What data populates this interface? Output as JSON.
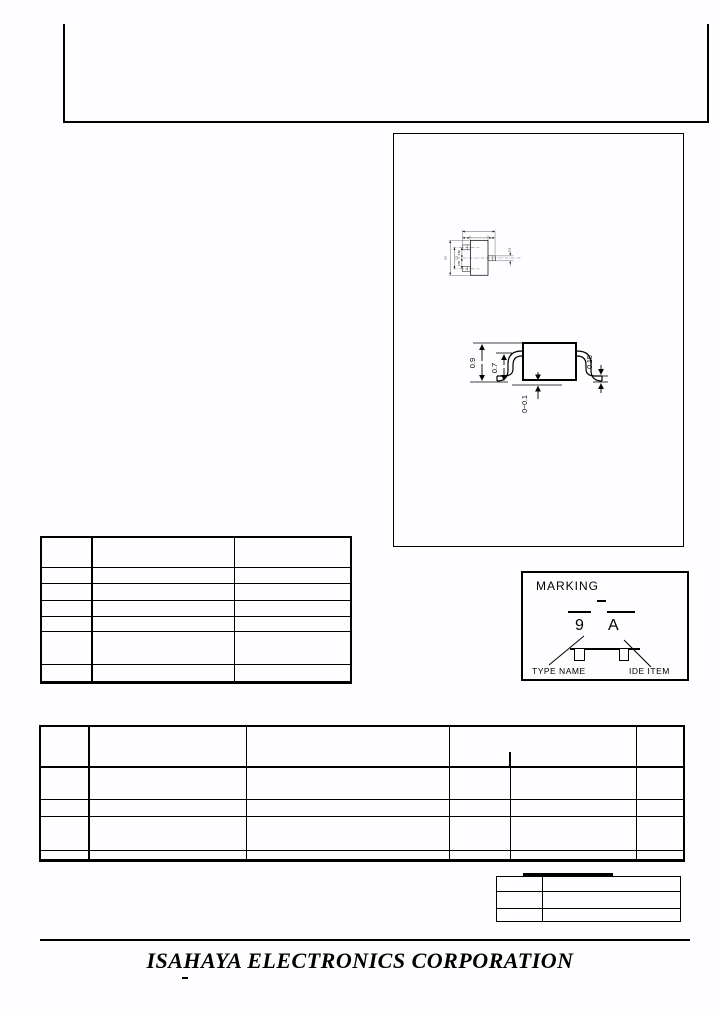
{
  "page": {
    "background": "#ffffff",
    "ink": "#000000"
  },
  "drawing": {
    "top_view": {
      "overall": "2.0",
      "lead_span": "1.3",
      "pitch_upper": "0.65",
      "pitch_lower": "0.35",
      "lead_width": "0.3"
    },
    "side_view": {
      "height": "0.9",
      "body_height": "0.7",
      "standoff": "0~0.1",
      "lead_thickness": "0.15"
    }
  },
  "marking": {
    "title": "MARKING",
    "type_char": "9",
    "lot_char": "A",
    "caption_left": "TYPE NAME",
    "caption_right": "IDE ITEM"
  },
  "footer": {
    "company": "ISAHAYA ELECTRONICS CORPORATION"
  }
}
